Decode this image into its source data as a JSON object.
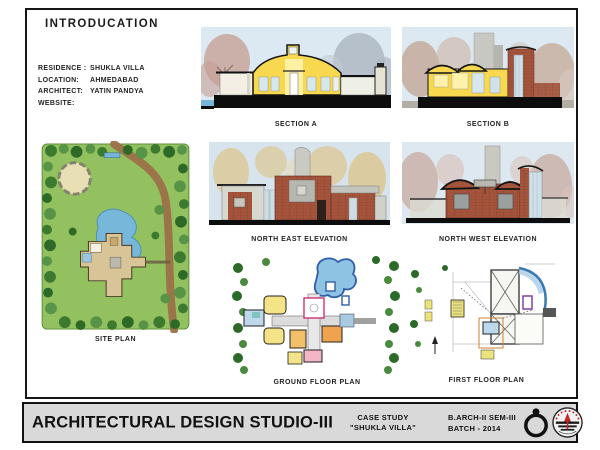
{
  "title": "INTRODUCATION",
  "info": {
    "rows": [
      {
        "label": "RESIDENCE :",
        "value": "SHUKLA VILLA"
      },
      {
        "label": "LOCATION:",
        "value": "AHMEDABAD"
      },
      {
        "label": "ARCHITECT:",
        "value": "YATIN PANDYA"
      },
      {
        "label": "WEBSITE:",
        "value": ""
      }
    ]
  },
  "drawings": [
    {
      "id": "section-a",
      "label": "SECTION A"
    },
    {
      "id": "section-b",
      "label": "SECTION B"
    },
    {
      "id": "site-plan",
      "label": "SITE PLAN"
    },
    {
      "id": "ne-elevation",
      "label": "NORTH EAST ELEVATION"
    },
    {
      "id": "nw-elevation",
      "label": "NORTH WEST ELEVATION"
    },
    {
      "id": "ground-floor",
      "label": "GROUND FLOOR PLAN"
    },
    {
      "id": "first-floor",
      "label": "FIRST FLOOR PLAN"
    }
  ],
  "footer": {
    "studio_title": "ARCHITECTURAL DESIGN STUDIO-III",
    "case_study_line1": "CASE STUDY",
    "case_study_line2": "\"SHUKLA VILLA\"",
    "batch_line1": "B.ARCH-II SEM-III",
    "batch_line2": "BATCH - 2014",
    "icons": [
      "compass-dial-icon",
      "institute-logo-icon"
    ]
  },
  "colors": {
    "frame_border": "#161616",
    "footer_bg": "#d9d9d9",
    "section_yellow": "#f7d84f",
    "section_yellow_light": "#fcf0a4",
    "brick_red": "#a5543c",
    "concrete_gray": "#c9cbc3",
    "sky_blue": "#dce8f2",
    "lawn_green": "#93c160",
    "tree_dark_green": "#2d6a27",
    "water_blue": "#77b7da",
    "path_brown": "#9b7148",
    "logo_red": "#c22527"
  }
}
